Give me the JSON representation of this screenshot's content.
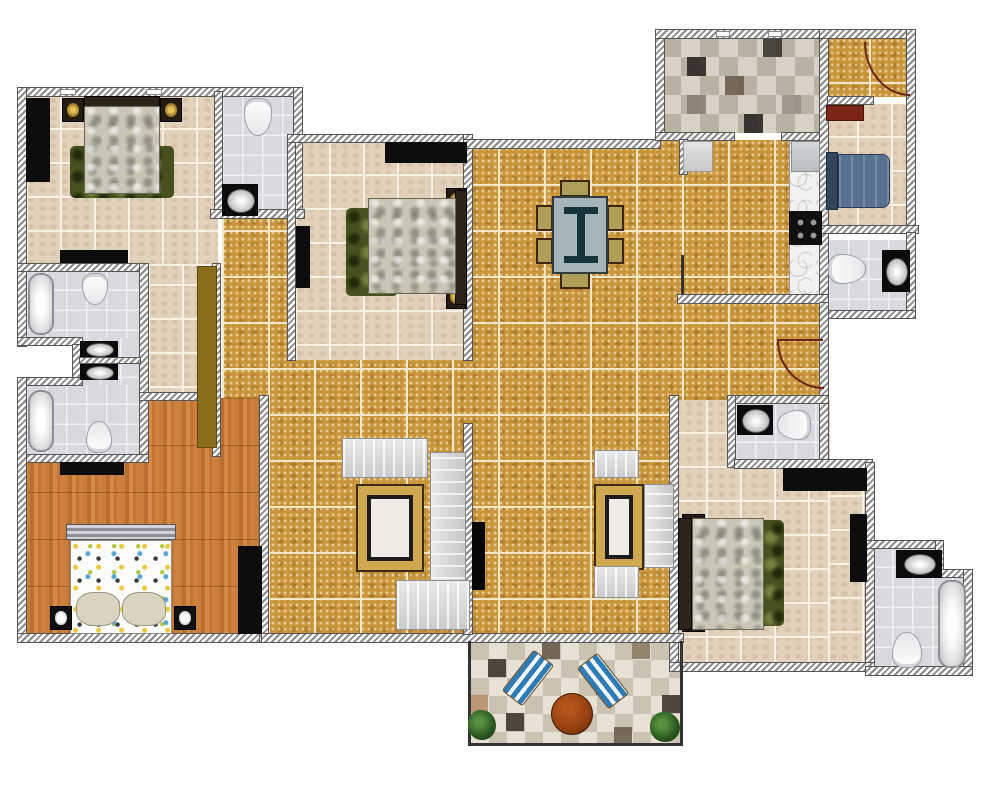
{
  "app": {
    "type": "apartment-floor-plan",
    "view": "2d-top-down",
    "visible_text": ""
  },
  "palette": {
    "wall": "#6f6f6f",
    "gold": "#c9953b",
    "gold-grout": "#f3e7c8",
    "beige": "#e2d1bb",
    "bath": "#d7d9de",
    "wood": "#c57c3a",
    "checker-a": "#d8d2c6",
    "checker-b": "#b9b1a2",
    "patio-a": "#e7e0d4",
    "patio-b": "#cbc2b2",
    "rug-green": "#47511d",
    "rug-gold": "#cfa84f",
    "bed-blue": "#5a7292",
    "maroon": "#7a2516",
    "table": "#a4b6ba",
    "chair": "#ac9f56",
    "lounger": "#2e7cb5",
    "patio-table": "#93400f",
    "plant": "#2e5c22",
    "arc": "#6b2417",
    "olive": "#8a6d1a",
    "black": "#0d0d0d"
  },
  "rooms": [
    {
      "id": "bedroom-top-left",
      "floor": "beige-tile"
    },
    {
      "id": "ensuite-bathroom",
      "floor": "bath-tile"
    },
    {
      "id": "bathroom-upper-left",
      "floor": "bath-tile"
    },
    {
      "id": "vanity-nook",
      "floor": "bath-tile"
    },
    {
      "id": "bathroom-lower-left",
      "floor": "bath-tile"
    },
    {
      "id": "kids-bedroom",
      "floor": "wood-plank"
    },
    {
      "id": "dressing-hall",
      "floor": "beige-tile"
    },
    {
      "id": "living-dining",
      "floor": "gold-mosaic-tile"
    },
    {
      "id": "bedroom-center",
      "floor": "beige-tile"
    },
    {
      "id": "kitchen",
      "floor": "checkered-tile"
    },
    {
      "id": "entry-foyer",
      "floor": "gold-mosaic-tile"
    },
    {
      "id": "bedroom-right",
      "floor": "beige-tile"
    },
    {
      "id": "bathroom-right",
      "floor": "bath-tile"
    },
    {
      "id": "guest-bathroom",
      "floor": "bath-tile"
    },
    {
      "id": "bedroom-bottom-right",
      "floor": "beige-tile"
    },
    {
      "id": "bathroom-bottom-right",
      "floor": "bath-tile"
    },
    {
      "id": "patio-balcony",
      "floor": "checkered-tile"
    }
  ],
  "furniture": [
    "double-bed",
    "double-bed",
    "double-bed",
    "kids-bed",
    "single-bed-blue",
    "dining-table-with-6-chairs",
    "sofa-set",
    "sofa-set",
    "area-rug",
    "area-rug",
    "green-rug",
    "green-rug",
    "bathtub",
    "bathtub",
    "bathtub",
    "toilet",
    "toilet",
    "toilet",
    "toilet",
    "toilet",
    "toilet",
    "sink",
    "sink",
    "sink",
    "sink",
    "sink",
    "sink",
    "sink",
    "wardrobe",
    "wardrobe",
    "wardrobe",
    "wardrobe",
    "dresser",
    "tv",
    "fridge",
    "stove",
    "kitchen-counter",
    "lounge-chair",
    "lounge-chair",
    "round-patio-table",
    "plant",
    "plant",
    "door-swing-arc",
    "door-swing-arc"
  ]
}
